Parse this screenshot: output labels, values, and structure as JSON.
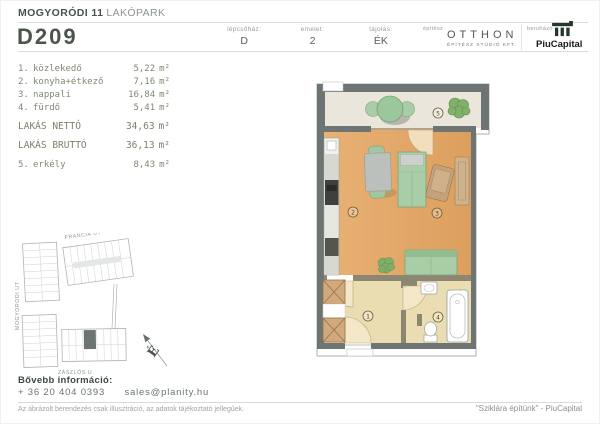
{
  "header": {
    "project": {
      "bold": "MOGYORÓDI 11",
      "light": "LAKÓPARK"
    },
    "unit_id": "D209",
    "fields": [
      {
        "label": "lépcsőház:",
        "value": "D"
      },
      {
        "label": "emelet:",
        "value": "2"
      },
      {
        "label": "tájolás:",
        "value": "ÉK"
      }
    ],
    "architect": {
      "label": "építész",
      "name": "OTTHON",
      "subtitle": "ÉPÍTÉSZ STÚDIÓ KFT."
    },
    "developer": {
      "label": "beruházó",
      "name": "PiuCapital"
    }
  },
  "area_table": {
    "unit": "m²",
    "rooms": [
      {
        "num": "1.",
        "name": "közlekedő",
        "area": "5,22"
      },
      {
        "num": "2.",
        "name": "konyha+étkező",
        "area": "7,16"
      },
      {
        "num": "3.",
        "name": "nappali",
        "area": "16,84"
      },
      {
        "num": "4.",
        "name": "fürdő",
        "area": "5,41"
      }
    ],
    "totals": [
      {
        "label": "LAKÁS NETTÓ",
        "area": "34,63"
      },
      {
        "label": "LAKÁS BRUTTÓ",
        "area": "36,13"
      }
    ],
    "extras": [
      {
        "num": "5.",
        "name": "erkély",
        "area": "8,43"
      }
    ]
  },
  "floorplan": {
    "markers": [
      "1",
      "2",
      "3",
      "4",
      "5"
    ]
  },
  "siteplan": {
    "street_top": "FRANCIA ÚT",
    "street_left": "MOGYORÓDI ÚT",
    "street_bottom": "ZÁSZLÓS U.",
    "north": "É"
  },
  "footer": {
    "info_label": "Bővebb információ:",
    "phone": "+ 36 20 404 0393",
    "email": "sales@planity.hu",
    "disclaimer": "Az ábrázolt berendezés csak illusztráció, az adatok tájékoztató jellegűek.",
    "slogan": "\"Sziklára építünk\" - PiuCapital"
  },
  "colors": {
    "accent_green": "#4b564b",
    "wall_gray": "#6e7472",
    "floor_orange": "#e4aa6c",
    "floor_beige": "#e9ddb1",
    "furniture_green": "#a9cda7",
    "logo_dark_green": "#24382c"
  }
}
